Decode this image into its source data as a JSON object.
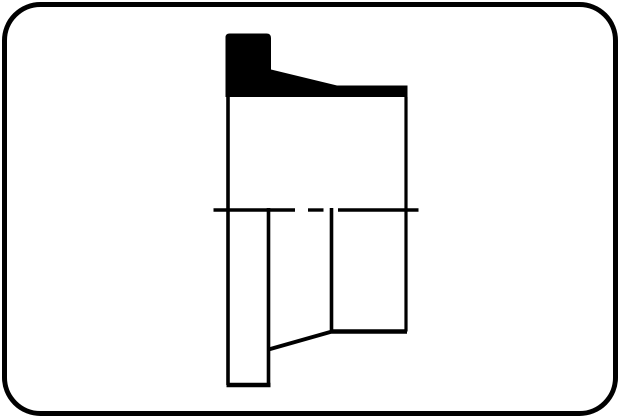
{
  "canvas": {
    "width": 620,
    "height": 418,
    "background": "#ffffff"
  },
  "frame": {
    "x": 4.5,
    "y": 4.5,
    "width": 611,
    "height": 409,
    "corner_radius": 36,
    "fill": "#ffffff",
    "stroke_color": "#000000",
    "stroke_width": 5
  },
  "drawing": {
    "subject": "flanged-sleeve-cross-section",
    "ink_color": "#000000",
    "outline_width": 3.5,
    "solid_profile": {
      "name": "seal-profile-solid",
      "path": "M225.5,97 L225.5,37.5 Q225.5,33.5 229.5,33.5 L266.5,33.5 Q271,33.5 271,38 L271,69.5 L337,85.5 L407.5,85.5 L407.5,97 Z"
    },
    "lines": [
      {
        "name": "body-left-edge",
        "x1": 228,
        "y1": 97,
        "x2": 228,
        "y2": 385,
        "width": 3.6
      },
      {
        "name": "flange-right-edge",
        "x1": 268.5,
        "y1": 208,
        "x2": 268.5,
        "y2": 385,
        "width": 3.6
      },
      {
        "name": "flange-bottom-edge",
        "x1": 226.5,
        "y1": 385,
        "x2": 270.5,
        "y2": 385,
        "width": 4.5
      },
      {
        "name": "taper-edge",
        "x1": 268.5,
        "y1": 349.5,
        "x2": 332,
        "y2": 331.5,
        "width": 4
      },
      {
        "name": "step-vertical-edge",
        "x1": 331.5,
        "y1": 208,
        "x2": 331.5,
        "y2": 331.5,
        "width": 3.6
      },
      {
        "name": "base-bottom-edge",
        "x1": 331.5,
        "y1": 331.5,
        "x2": 407,
        "y2": 331.5,
        "width": 4.5
      },
      {
        "name": "body-right-edge",
        "x1": 406,
        "y1": 97,
        "x2": 406,
        "y2": 331.5,
        "width": 3.2
      }
    ],
    "centerline": {
      "name": "centerline",
      "y": 210,
      "width": 3.4,
      "segments": [
        [
          213.5,
          295
        ],
        [
          308,
          323.5
        ],
        [
          338,
          418.5
        ]
      ]
    }
  }
}
